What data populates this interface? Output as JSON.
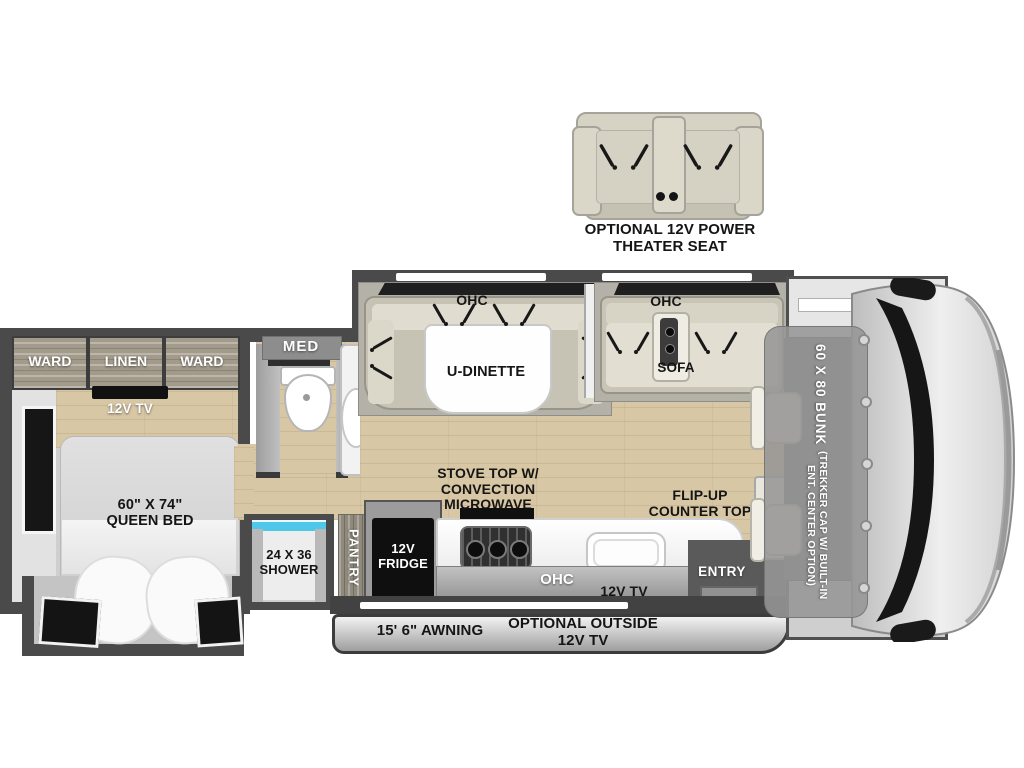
{
  "theater": {
    "label": "OPTIONAL 12V POWER\nTHEATER SEAT"
  },
  "bedroom": {
    "cabinets": [
      "WARD",
      "LINEN",
      "WARD"
    ],
    "tv": "12V TV",
    "bed": "60\" X 74\"\nQUEEN BED"
  },
  "bathroom": {
    "med": "MED",
    "shower": "24 X 36\nSHOWER"
  },
  "dinette": {
    "ohc": "OHC",
    "label": "U-DINETTE"
  },
  "sofa": {
    "ohc": "OHC",
    "label": "SOFA"
  },
  "kitchen": {
    "pantry": "PANTRY",
    "fridge": "12V\nFRIDGE",
    "stove": "STOVE TOP W/\nCONVECTION\nMICROWAVE",
    "flip_counter": "FLIP-UP\nCOUNTER TOP",
    "ohc": "OHC",
    "tv": "12V TV",
    "entry": "ENTRY"
  },
  "cab": {
    "bunk": "60 X 80 BUNK",
    "bunk_option": "(TREKKER CAP W/ BUILT-IN\nENT. CENTER OPTION)"
  },
  "exterior": {
    "awning": "15' 6\" AWNING",
    "outside_tv": "OPTIONAL OUTSIDE\n12V TV"
  },
  "colors": {
    "wall": "#4a4a4a",
    "floor_wood": "#d8c7a5",
    "cabinet_wood": "#a29a8a",
    "cushion": "#d6d2c3",
    "shower_glass": "#4ec7e8",
    "fridge": "#0f0f0f"
  }
}
